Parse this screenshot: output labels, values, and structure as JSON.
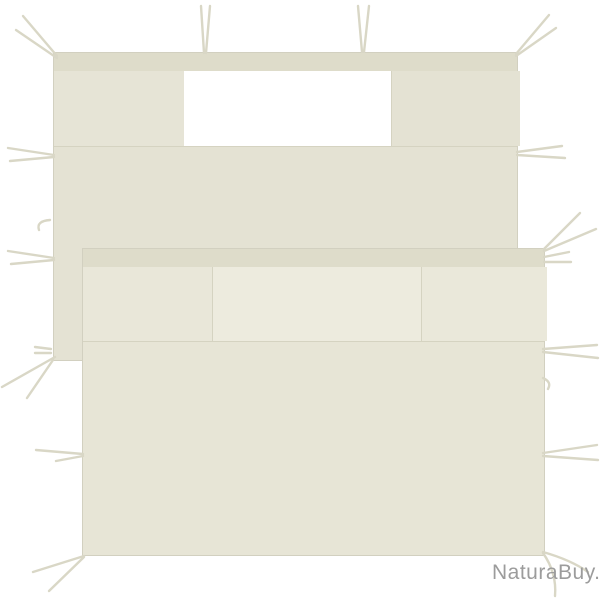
{
  "image": {
    "type": "product-photo",
    "subject": "Two cream gazebo sidewall panels with window opening and tie strings, overlapping on a white background"
  },
  "colors": {
    "bg": "#ffffff",
    "fabric": "#e4e2d3",
    "fabric_light": "#e7e5d6",
    "band": "#dedcca",
    "section_left": "#e6e4d6",
    "section_c1": "#e9e7d9",
    "section_mid": "#edebde",
    "section_right": "#eae8da",
    "seam": "#d5d3c1",
    "edge": "#d2d0c0",
    "window": "#ffffff",
    "tie": "#d9d7c6",
    "watermark": "#9c9c9c"
  },
  "watermark": {
    "text": "NaturaBuy."
  }
}
